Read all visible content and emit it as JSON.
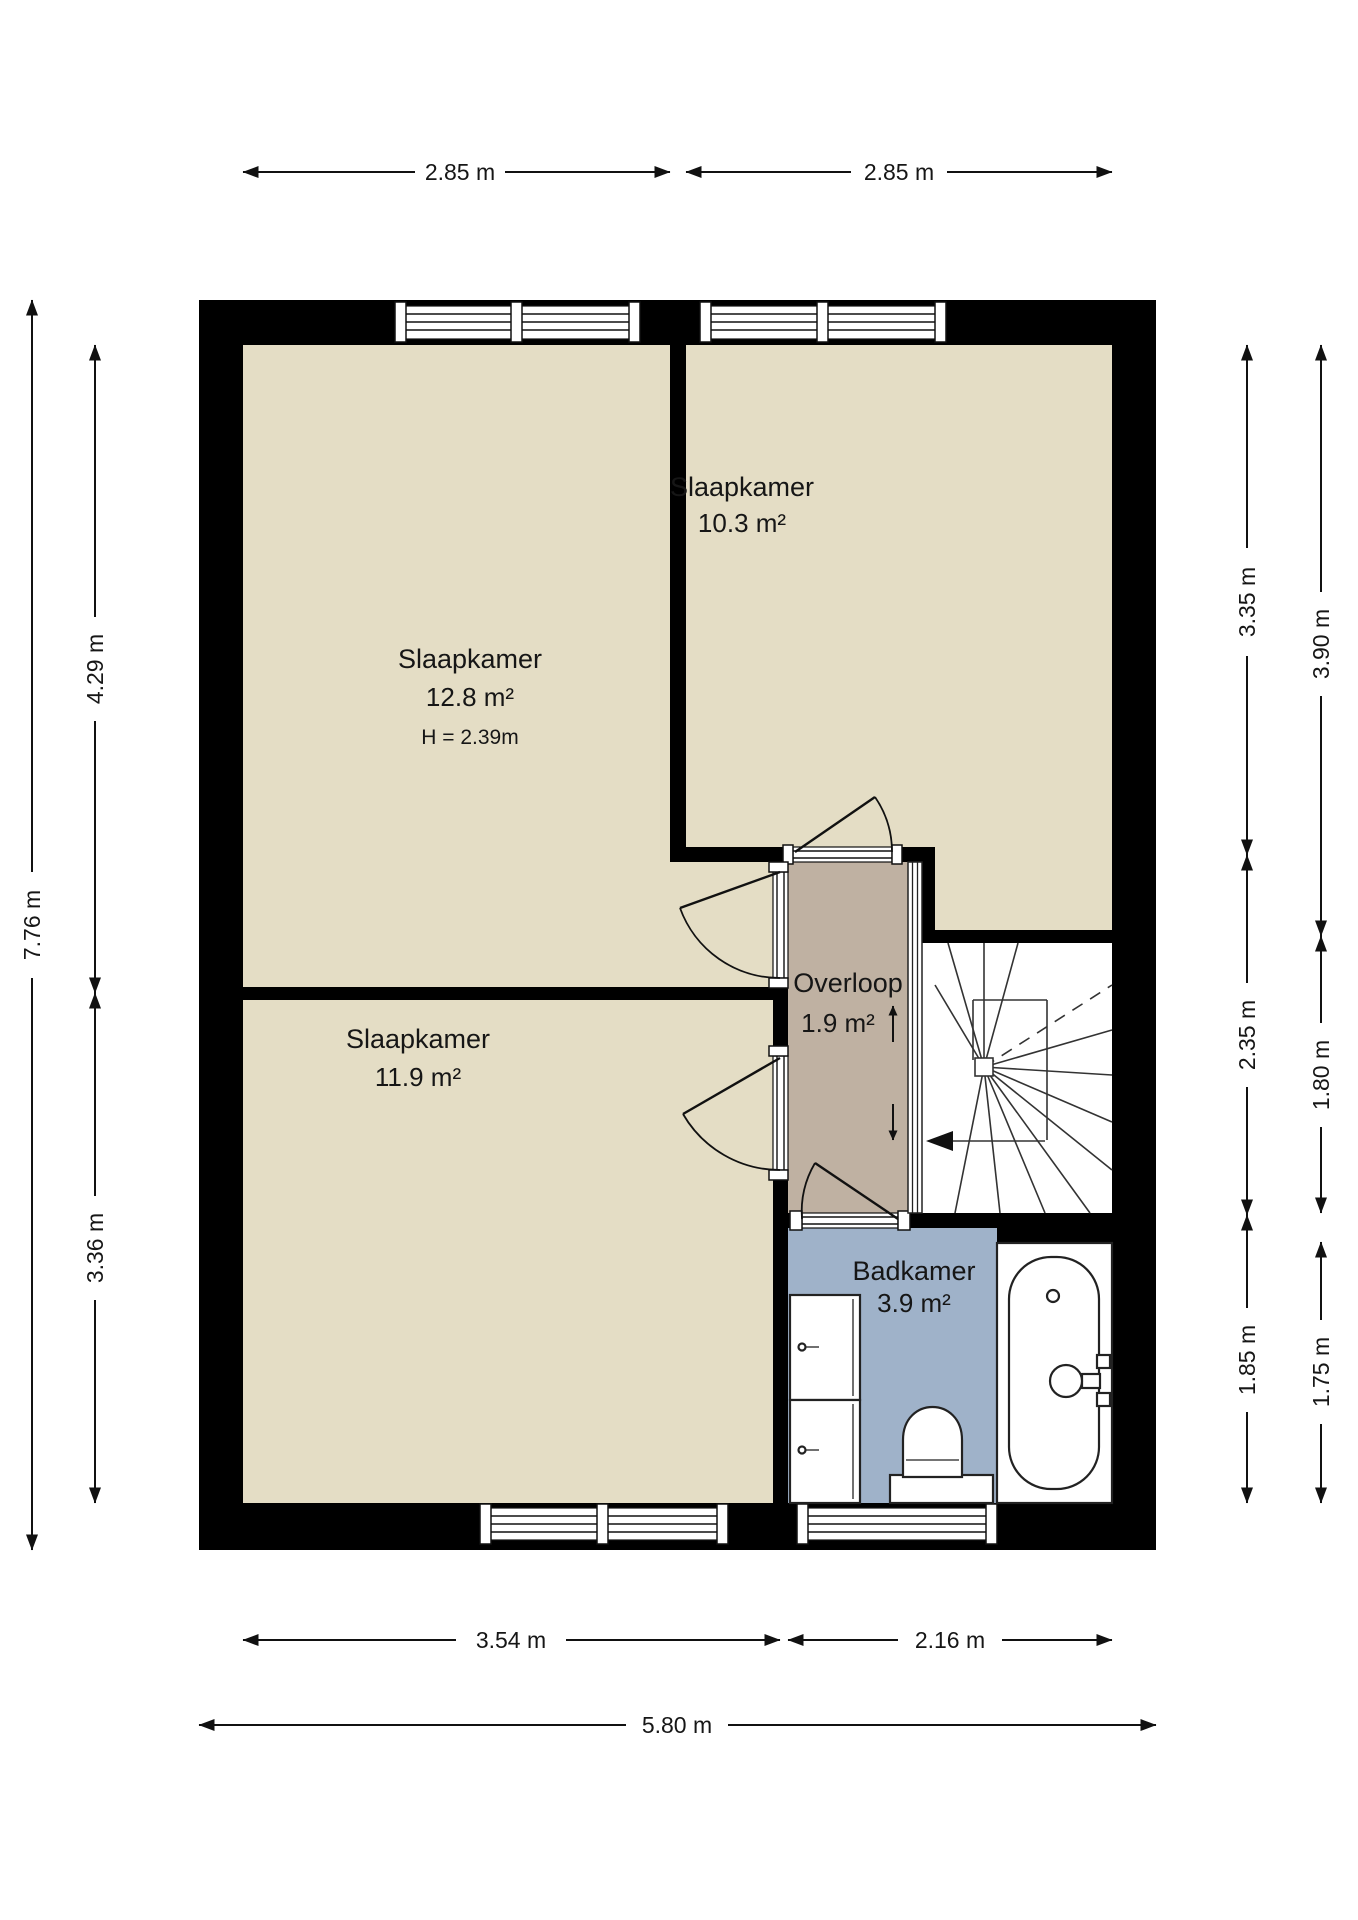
{
  "rooms": [
    {
      "name": "Slaapkamer",
      "area": "12.8 m²",
      "ceiling": "H = 2.39m"
    },
    {
      "name": "Slaapkamer",
      "area": "10.3 m²"
    },
    {
      "name": "Slaapkamer",
      "area": "11.9 m²"
    },
    {
      "name": "Overloop",
      "area": "1.9 m²"
    },
    {
      "name": "Badkamer",
      "area": "3.9 m²"
    }
  ],
  "dims": {
    "top": [
      "2.85 m",
      "2.85 m"
    ],
    "left_outer": "7.76 m",
    "left_inner": [
      "4.29 m",
      "3.36 m"
    ],
    "right_inner": [
      "3.35 m",
      "2.35 m",
      "1.85 m"
    ],
    "right_outer": [
      "3.90 m",
      "1.80 m",
      "1.75 m"
    ],
    "bottom": [
      "3.54 m",
      "2.16 m"
    ],
    "bottom_total": "5.80 m"
  },
  "colors": {
    "bedroom_floor": "#E4DDC5",
    "landing_floor": "#BFB1A2",
    "bathroom_floor": "#9FB2C9",
    "wall": "#000000",
    "line": "#111111"
  },
  "icons": {
    "stairs_up_arrow": "↑",
    "stairs_down_arrow": "↓",
    "stairs_entry_arrow": "◄"
  }
}
